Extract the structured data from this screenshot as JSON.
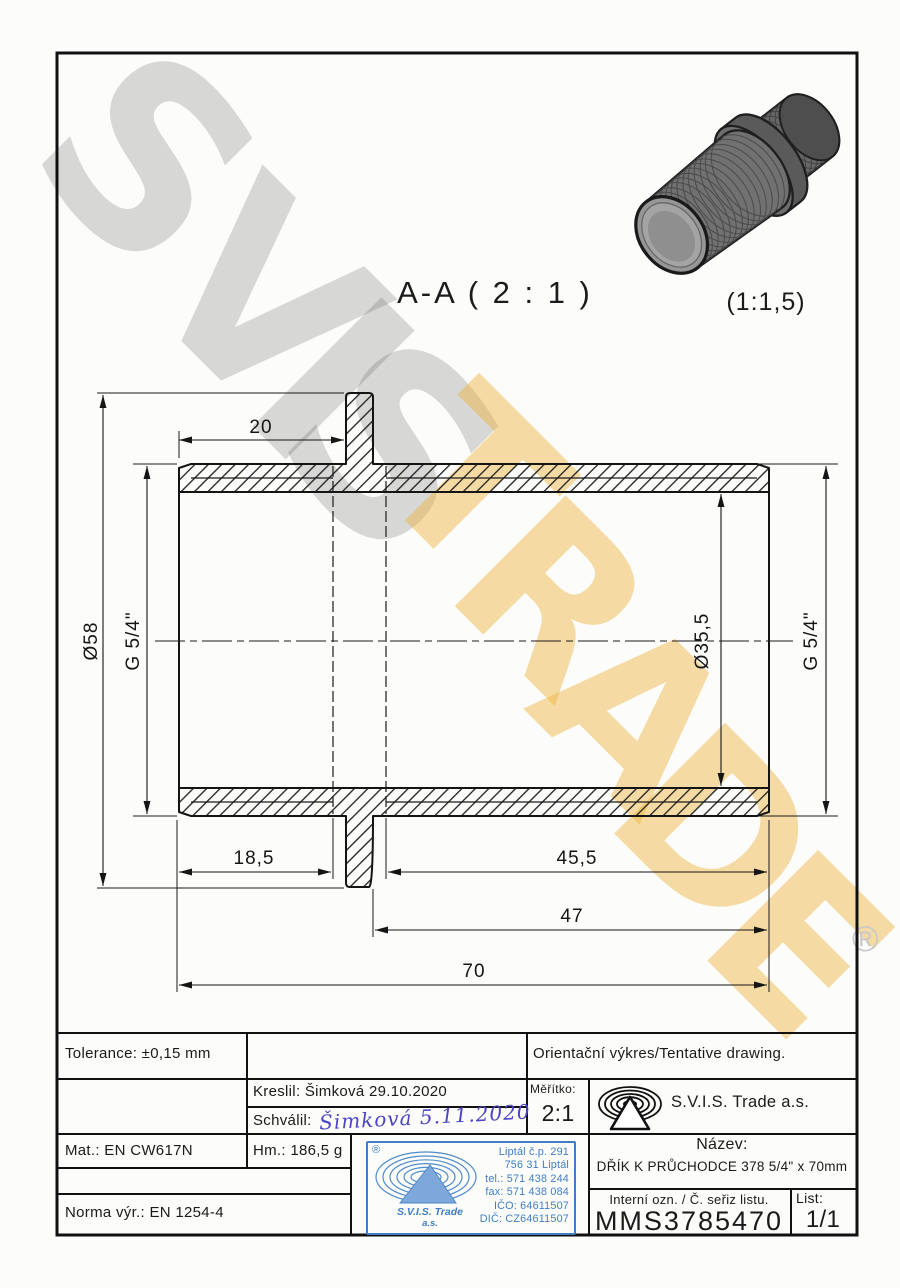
{
  "labels": {
    "section": "A-A ( 2 : 1 )",
    "render_scale": "(1:1,5)"
  },
  "dims": {
    "top_width": "20",
    "outer_dia": "Ø58",
    "thread_left": "G 5/4\"",
    "bore_dia": "Ø35,5",
    "thread_right": "G 5/4\"",
    "len_left": "18,5",
    "len_right": "45,5",
    "len_to_collar": "47",
    "len_total": "70"
  },
  "watermark": {
    "word1": [
      "S",
      "V",
      "I",
      "S"
    ],
    "word2": [
      "T",
      "R",
      "A",
      "D",
      "E"
    ],
    "registered": "®"
  },
  "title_block": {
    "tolerance": "Tolerance: ±0,15 mm",
    "orientation_note": "Orientační výkres/Tentative drawing.",
    "kreslil": "Kreslil: Šimková 29.10.2020",
    "schvalil_label": "Schválil:",
    "schvalil_signature": "Šimková  5.11.2020",
    "meritko_label": "Měřítko:",
    "meritko_value": "2:1",
    "company": "S.V.I.S. Trade a.s.",
    "mat": "Mat.: EN CW617N",
    "hm": "Hm.: 186,5 g",
    "norma": "Norma výr.: EN 1254-4",
    "nazev_label": "Název:",
    "nazev_value": "DŘÍK K PRŮCHODCE 378 5/4\" x 70mm",
    "interni_label": "Interní ozn. / Č. seřiz listu.",
    "interni_value": "MMS3785470",
    "list_label": "List:",
    "list_value": "1/1"
  },
  "stamp": {
    "registered": "®",
    "company_line1": "S.V.I.S. Trade",
    "company_line2": "a.s.",
    "address": [
      "Liptál č.p. 291",
      "756 31 Liptál",
      "tel.: 571 438 244",
      "fax: 571 438 084",
      "IČO: 64611507",
      "DIČ: CZ64611507"
    ]
  },
  "colors": {
    "stamp_blue": "#3e7ec6",
    "signature_ink": "#4b44c6",
    "watermark_yellow": "#eeb43a",
    "watermark_gray": "#c8c8c8",
    "line_black": "#151515"
  }
}
